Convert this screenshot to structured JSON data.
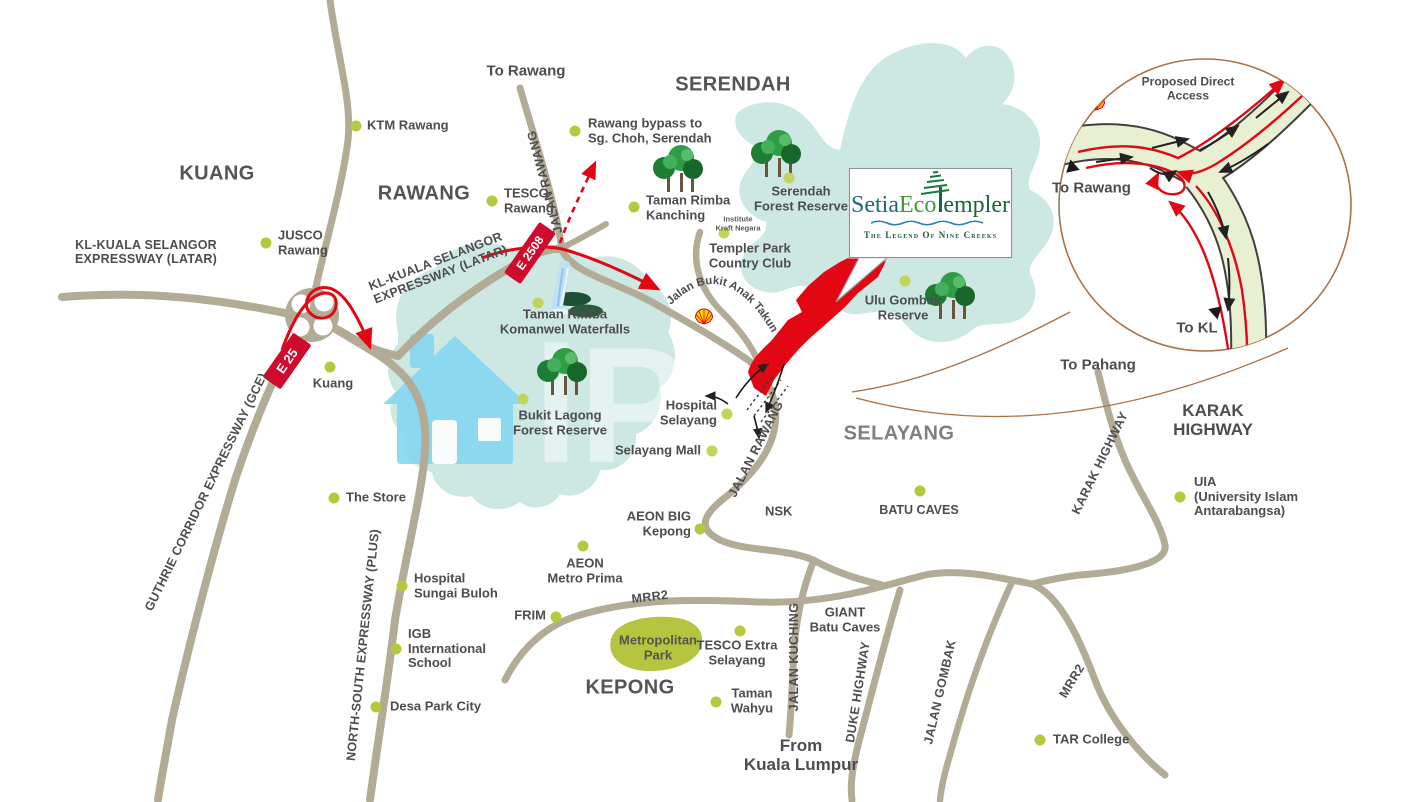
{
  "logo_card": {
    "setia": "Setia",
    "eco": "Eco",
    "templer_rest": "empler",
    "tagline": "The Legend Of Nine Creeks"
  },
  "areas": {
    "kuang": "KUANG",
    "rawang": "RAWANG",
    "serendah": "SERENDAH",
    "selayang": "SELAYANG",
    "kepong": "KEPONG",
    "karak_l1": "KARAK",
    "karak_l2": "HIGHWAY"
  },
  "directions": {
    "to_rawang_top": "To Rawang",
    "to_pahang": "To Pahang",
    "from_kl_l1": "From",
    "from_kl_l2": "Kuala Lumpur"
  },
  "expressways": {
    "latar_l1": "KL-KUALA SELANGOR",
    "latar_l2": "EXPRESSWAY (LATAR)",
    "gce": "GUTHRIE CORRIDOR EXPRESSWAY (GCE)",
    "plus": "NORTH-SOUTH EXPRESSWAY (PLUS)"
  },
  "road_names": {
    "jalan_rawang": "JALAN RAWANG",
    "mrr2": "MRR2",
    "jalan_kuching": "JALAN KUCHING",
    "duke": "DUKE HIGHWAY",
    "jalan_gombak": "JALAN GOMBAK",
    "karak": "KARAK HIGHWAY",
    "bukit_anak_takun": "Jalan Bukit Anak Takun"
  },
  "badges": {
    "e25": "E 25",
    "e2508": "E 2508"
  },
  "inset": {
    "title_l1": "Proposed Direct",
    "title_l2": "Access",
    "to_rawang": "To Rawang",
    "to_kl": "To KL"
  },
  "pois": {
    "ktm": {
      "l1": "KTM Rawang"
    },
    "jusco": {
      "l1": "JUSCO",
      "l2": "Rawang"
    },
    "tesco": {
      "l1": "TESCO",
      "l2": "Rawang"
    },
    "bypass": {
      "l1": "Rawang bypass to",
      "l2": "Sg. Choh, Serendah"
    },
    "kanching": {
      "l1": "Taman Rimba",
      "l2": "Kanching"
    },
    "serendah_fr": {
      "l1": "Serendah",
      "l2": "Forest Reserve"
    },
    "templer_cc": {
      "l1": "Templer Park",
      "l2": "Country Club"
    },
    "ulu_gombak": {
      "l1": "Ulu Gombak",
      "l2": "Reserve"
    },
    "kuang": {
      "l1": "Kuang"
    },
    "the_store": {
      "l1": "The Store"
    },
    "komanwel": {
      "l1": "Taman Rimba",
      "l2": "Komanwel Waterfalls"
    },
    "bukit_lagong": {
      "l1": "Bukit Lagong",
      "l2": "Forest Reserve"
    },
    "hospital_selayang": {
      "l1": "Hospital",
      "l2": "Selayang"
    },
    "selayang_mall": {
      "l1": "Selayang Mall"
    },
    "batu_caves": {
      "l1": "BATU CAVES"
    },
    "nsk": {
      "l1": "NSK"
    },
    "aeon_big": {
      "l1": "AEON BIG",
      "l2": "Kepong"
    },
    "aeon_metro": {
      "l1": "AEON",
      "l2": "Metro Prima"
    },
    "frim": {
      "l1": "FRIM"
    },
    "hosp_sg_buloh": {
      "l1": "Hospital",
      "l2": "Sungai Buloh"
    },
    "igb": {
      "l1": "IGB",
      "l2": "International",
      "l3": "School"
    },
    "desa_park": {
      "l1": "Desa Park City"
    },
    "metropolitan": {
      "l1": "Metropolitan",
      "l2": "Park"
    },
    "tesco_extra": {
      "l1": "TESCO Extra",
      "l2": "Selayang"
    },
    "taman_wahyu": {
      "l1": "Taman",
      "l2": "Wahyu"
    },
    "giant": {
      "l1": "GIANT",
      "l2": "Batu Caves"
    },
    "tar": {
      "l1": "TAR College"
    },
    "uia": {
      "l1": "UIA",
      "l2": "(University Islam",
      "l3": "Antarabangsa)"
    },
    "kraft": {
      "l1": "Institute",
      "l2": "Kraft Negara"
    }
  },
  "colors": {
    "road": "#b2ab95",
    "forest": "#cde8e2",
    "marker": "#b6c93e",
    "route_red": "#e30613",
    "badge_red": "#cf0a2c",
    "label": "#4d4d4f",
    "park_green": "#b6c43f",
    "watermark_blue": "#86d7f2",
    "inset_ring": "#a87248"
  }
}
